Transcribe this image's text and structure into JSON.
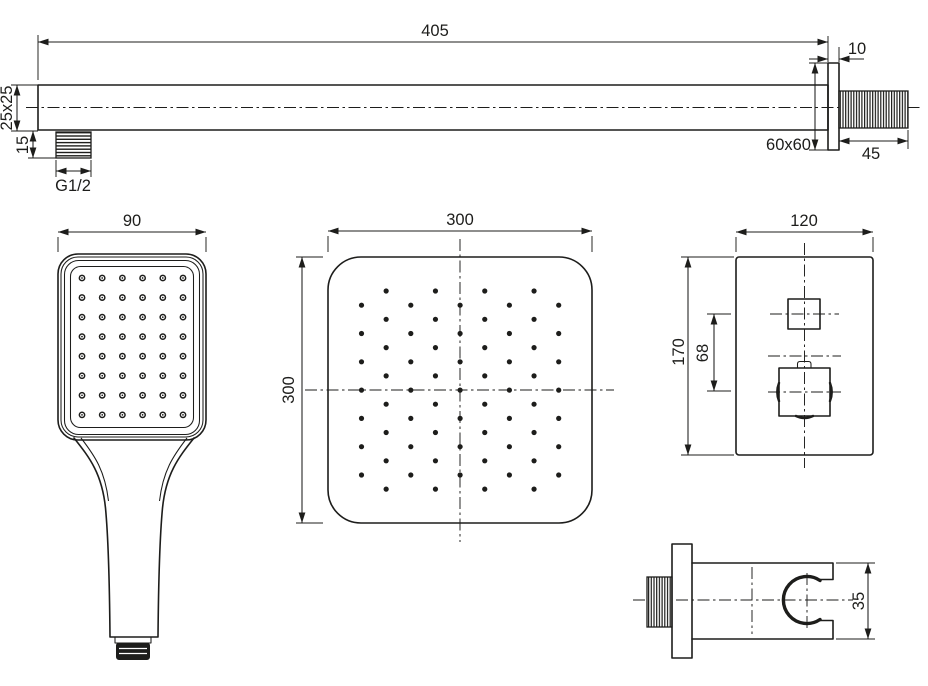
{
  "document": {
    "type": "technical-dimension-drawing",
    "product": "shower set components"
  },
  "colors": {
    "ink": "#1d1d1b",
    "paper": "#ffffff"
  },
  "views": {
    "shower_arm": {
      "name": "wall-mounted shower arm, side view",
      "labels": {
        "length": "405",
        "profile": "25x25",
        "outlet_thread_length": "15",
        "outlet_thread": "G1/2",
        "flange_thickness": "10",
        "flange_size": "60x60",
        "inlet_length": "45"
      }
    },
    "hand_shower": {
      "name": "hand shower, front view",
      "labels": {
        "width": "90"
      },
      "nozzles": {
        "columns": 6,
        "rows": 8
      }
    },
    "overhead_shower": {
      "name": "overhead square shower head, face view",
      "labels": {
        "width": "300",
        "height": "300"
      },
      "nozzles": {
        "pattern": "staggered",
        "columns": 9,
        "rows_short": 7,
        "rows_long": 8
      }
    },
    "mixer": {
      "name": "concealed thermostatic mixer, front view",
      "labels": {
        "width": "120",
        "height": "170",
        "handle_spacing": "68"
      }
    },
    "wall_outlet": {
      "name": "wall outlet elbow with hand shower holder, side view",
      "labels": {
        "height": "35"
      }
    }
  }
}
